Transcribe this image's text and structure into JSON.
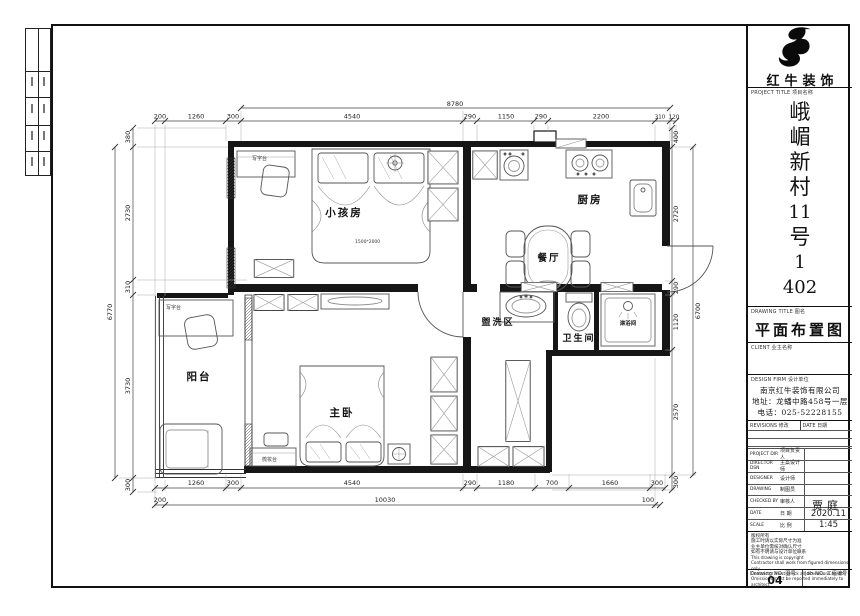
{
  "title_block": {
    "brand": "红牛装饰",
    "logo_icon": "bull-logo",
    "project_title_label": "PROJECT TITLE  项目名称",
    "project_name_chars": [
      "峨",
      "嵋",
      "新",
      "村",
      "11",
      "号",
      "1",
      "402"
    ],
    "drawing_title_label": "DRAWING TITLE  图名",
    "drawing_title": "平面布置图",
    "client_label": "CLIENT  业主名称",
    "design_firm_label": "DESIGN FIRM  设计单位",
    "firm_name": "南京红牛装饰有限公司",
    "firm_address": "地址：龙蟠中路458号一层",
    "firm_phone": "电话：025-52228155",
    "revisions_label": "REVISIONS  修改",
    "date_col_label": "DATE  日期",
    "rows": [
      {
        "label": "PROJECT DIR",
        "cn": "项目负责人",
        "value": ""
      },
      {
        "label": "DIRECTOR DSN",
        "cn": "主案设计师",
        "value": ""
      },
      {
        "label": "DESIGNER",
        "cn": "设计师",
        "value": ""
      },
      {
        "label": "DRAWING",
        "cn": "制图员",
        "value": ""
      },
      {
        "label": "CHECKED BY",
        "cn": "审核人",
        "value": ""
      },
      {
        "label": "DATE",
        "cn": "日 期",
        "value": "2020.11"
      },
      {
        "label": "SCALE",
        "cn": "比 例",
        "value": "1:45"
      }
    ],
    "designer_value": "贾庭",
    "notes_cn": [
      "版权所有",
      "施工时请以实际尺寸为准",
      "业主单位需核对确认尺寸",
      "如有不明请与设计单位联系"
    ],
    "notes_en": [
      "This drawing is copyright",
      "Contractor shall work from figured dimensions only",
      "Contractor must check all dimensions on site",
      "Omissions must be reported immediately to architect"
    ],
    "drawing_no_label": "Drawing NO. 图号",
    "drawing_no": "04",
    "job_no_label": "Job NO. 工程编号"
  },
  "plan": {
    "room_labels": {
      "kids_room": "小孩房",
      "kitchen": "厨房",
      "dining": "餐厅",
      "wash_area": "盥洗区",
      "bathroom": "卫生间",
      "shower": "淋浴间",
      "balcony": "阳台",
      "master_bedroom": "主卧"
    },
    "furniture_labels": {
      "desk1": "写字台",
      "desk2": "写字台",
      "dresser": "梳妆台",
      "bed_size": "1500*2000"
    },
    "dims": {
      "top_overall": "8780",
      "top": [
        "200",
        "1260",
        "300",
        "4540",
        "290",
        "1150",
        "290",
        "2200",
        "310",
        "120"
      ],
      "bottom": [
        "1260",
        "300",
        "4540",
        "290",
        "1180",
        "700",
        "1660",
        "300"
      ],
      "bottom_overall": [
        "200",
        "10030",
        "100"
      ],
      "left": [
        "380",
        "2730",
        "310",
        "3730",
        "300"
      ],
      "left_overall": "6770",
      "right": [
        "400",
        "2720",
        "290",
        "1120",
        "2570",
        "300"
      ],
      "right_overall": "6700"
    }
  }
}
